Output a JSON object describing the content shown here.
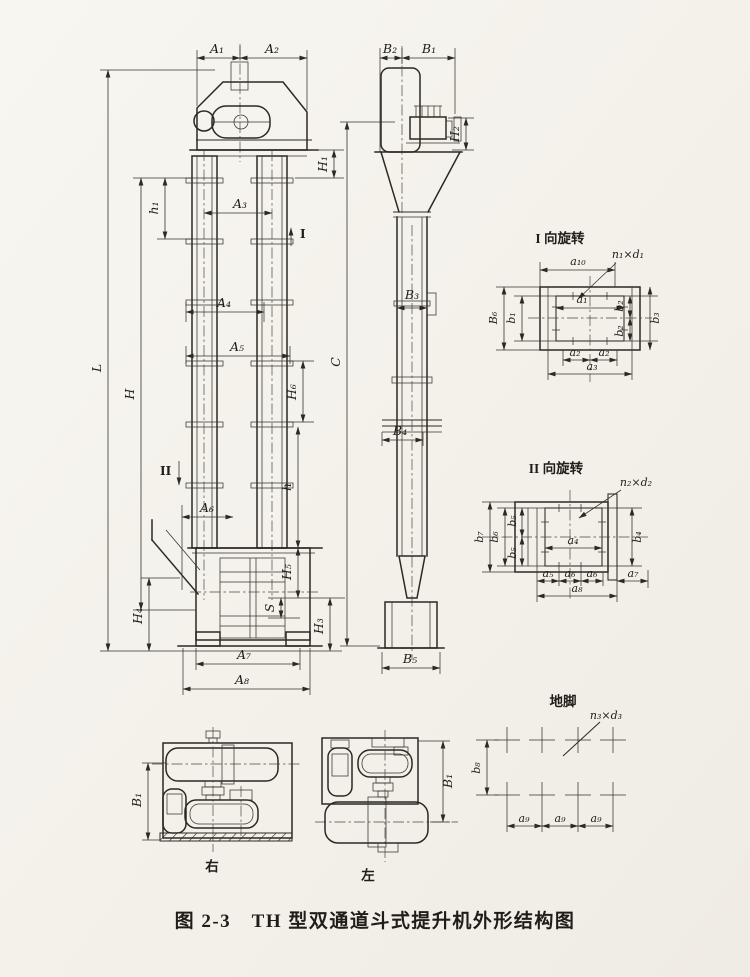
{
  "colors": {
    "paper": "#f6f4ee",
    "ink": "#2b2922"
  },
  "caption": "图 2-3　TH 型双通道斗式提升机外形结构图",
  "front_view": {
    "dims": {
      "A1": "A₁",
      "A2": "A₂",
      "A3": "A₃",
      "A4": "A₄",
      "A5": "A₅",
      "A6": "A₆",
      "A7": "A₇",
      "A8": "A₈",
      "h1": "h₁",
      "H1": "H₁",
      "H3": "H₃",
      "H4": "H₄",
      "H5": "H₅",
      "H6": "H₆",
      "h": "h",
      "S": "S",
      "L": "L",
      "H": "H"
    },
    "section_markers": {
      "I": "I",
      "II": "II"
    }
  },
  "side_view": {
    "dims": {
      "B1": "B₁",
      "B2": "B₂",
      "B3": "B₃",
      "B4": "B₄",
      "B5": "B₅",
      "H2": "H₂",
      "C": "C"
    }
  },
  "detail_rotation_1": {
    "title": "I 向旋转",
    "bolt_callout": "n₁×d₁",
    "dims": {
      "a10": "a₁₀",
      "a1": "a₁",
      "B6": "B₆",
      "b1": "b₁",
      "b2_top": "b₂",
      "b2_bottom": "b₂",
      "b3": "b₃",
      "a2_left": "a₂",
      "a2_right": "a₂",
      "a3": "a₃"
    }
  },
  "detail_rotation_2": {
    "title": "II 向旋转",
    "bolt_callout": "n₂×d₂",
    "dims": {
      "a4": "a₄",
      "a5": "a₅",
      "a6_left": "a₆",
      "a6_right": "a₆",
      "a7": "a₇",
      "a8": "a₈",
      "b4": "b₄",
      "b5_upper": "b₅",
      "b5_lower": "b₅",
      "b6": "b₆",
      "b7": "b₇"
    }
  },
  "foundation": {
    "title": "地脚",
    "bolt_callout": "n₃×d₃",
    "dims": {
      "b8": "b₈",
      "a9_1": "a₉",
      "a9_2": "a₉",
      "a9_3": "a₉"
    }
  },
  "bottom_views": {
    "right": {
      "label": "右",
      "dim_B1": "B₁"
    },
    "left": {
      "label": "左",
      "dim_B1": "B₁"
    }
  }
}
